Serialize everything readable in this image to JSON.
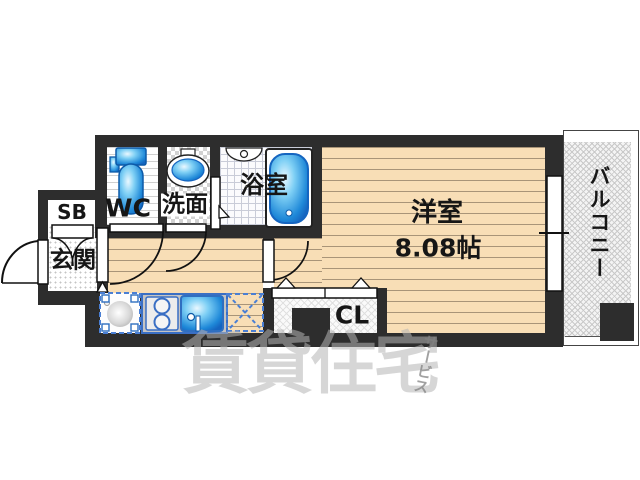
{
  "floorplan": {
    "rooms": {
      "western_room": {
        "label": "洋室",
        "size": "8.08帖"
      },
      "balcony": {
        "label": "バルコニー"
      },
      "entrance": {
        "label": "玄関"
      },
      "shoe_box": {
        "label": "SB"
      },
      "toilet": {
        "label": "WC"
      },
      "washroom": {
        "label": "洗面"
      },
      "bathroom": {
        "label": "浴室"
      },
      "closet": {
        "label": "CL"
      }
    },
    "watermark": {
      "main": "賃貸住宅",
      "sub": "サービス"
    },
    "colors": {
      "wall": "#2d2d2d",
      "wood_floor": "#f8deb6",
      "fixture_blue": "#1e88d8",
      "fixture_border": "#1565c0",
      "kitchen_outline": "#3a6fc4"
    }
  }
}
